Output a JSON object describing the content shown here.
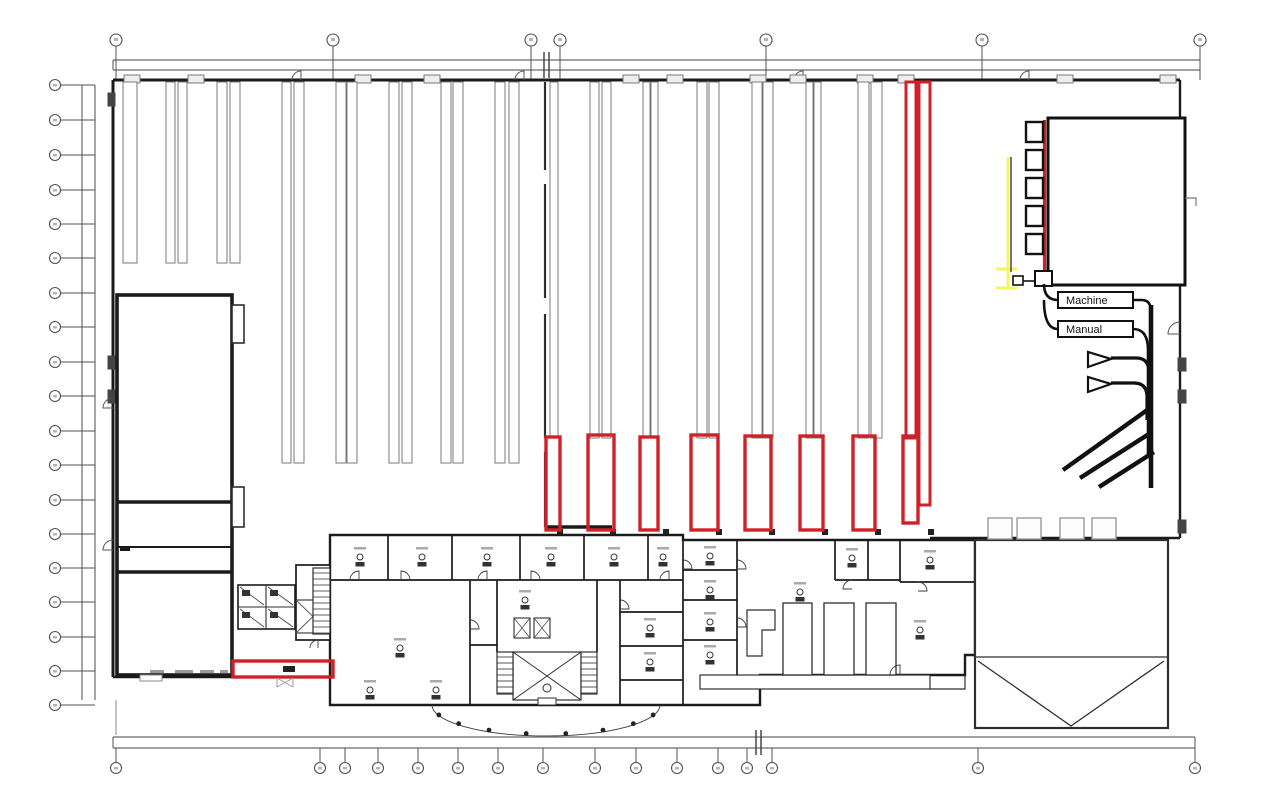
{
  "annotations": {
    "machine_label": "Machine",
    "manual_label": "Manual"
  },
  "colors": {
    "wall": "#1b1b1b",
    "thin": "#2e2e2e",
    "aisle": "#787878",
    "grid": "#505050",
    "light": "#9a9a9a",
    "red": "#d02128",
    "yellow": "#f6f463",
    "faint": "#b5b5b5"
  },
  "grid": {
    "top_bubble_y": 40,
    "top_bubble_xs": [
      116,
      333,
      531,
      560,
      766,
      982,
      1200
    ],
    "left_bubble_x": 55,
    "left_bubble_ys": [
      85,
      120,
      155,
      190,
      224,
      258,
      293,
      327,
      362,
      396,
      431,
      465,
      500,
      534,
      568,
      602,
      637,
      671,
      705
    ],
    "bottom_bubble_y": 768,
    "bottom_bubble_xs": [
      116,
      320,
      345,
      378,
      418,
      458,
      498,
      543,
      595,
      636,
      677,
      718,
      747,
      772,
      978,
      1195
    ]
  },
  "warehouse": {
    "aisle_strips": [
      {
        "x": 123,
        "w": 14,
        "y1": 82,
        "y2": 263
      },
      {
        "x": 166,
        "w": 9,
        "y1": 82,
        "y2": 263
      },
      {
        "x": 178,
        "w": 9,
        "y1": 82,
        "y2": 263
      },
      {
        "x": 217,
        "w": 10,
        "y1": 82,
        "y2": 263
      },
      {
        "x": 230,
        "w": 10,
        "y1": 82,
        "y2": 263
      },
      {
        "x": 282,
        "w": 9,
        "y1": 82,
        "y2": 463
      },
      {
        "x": 294,
        "w": 10,
        "y1": 82,
        "y2": 463
      },
      {
        "x": 336,
        "w": 10,
        "y1": 82,
        "y2": 463
      },
      {
        "x": 347,
        "w": 10,
        "y1": 82,
        "y2": 463
      },
      {
        "x": 389,
        "w": 10,
        "y1": 82,
        "y2": 463
      },
      {
        "x": 402,
        "w": 10,
        "y1": 82,
        "y2": 463
      },
      {
        "x": 441,
        "w": 10,
        "y1": 82,
        "y2": 463
      },
      {
        "x": 453,
        "w": 10,
        "y1": 82,
        "y2": 463
      },
      {
        "x": 495,
        "w": 10,
        "y1": 82,
        "y2": 463
      },
      {
        "x": 509,
        "w": 10,
        "y1": 82,
        "y2": 463
      },
      {
        "x": 550,
        "w": 8,
        "y1": 82,
        "y2": 438
      },
      {
        "x": 590,
        "w": 9,
        "y1": 82,
        "y2": 438
      },
      {
        "x": 602,
        "w": 9,
        "y1": 82,
        "y2": 438
      },
      {
        "x": 643,
        "w": 7,
        "y1": 82,
        "y2": 438
      },
      {
        "x": 651,
        "w": 7,
        "y1": 82,
        "y2": 438
      },
      {
        "x": 697,
        "w": 10,
        "y1": 82,
        "y2": 438
      },
      {
        "x": 709,
        "w": 10,
        "y1": 82,
        "y2": 438
      },
      {
        "x": 752,
        "w": 10,
        "y1": 82,
        "y2": 438
      },
      {
        "x": 763,
        "w": 10,
        "y1": 82,
        "y2": 438
      },
      {
        "x": 806,
        "w": 7,
        "y1": 82,
        "y2": 438
      },
      {
        "x": 814,
        "w": 7,
        "y1": 82,
        "y2": 438
      },
      {
        "x": 858,
        "w": 11,
        "y1": 82,
        "y2": 438
      },
      {
        "x": 871,
        "w": 11,
        "y1": 82,
        "y2": 438
      }
    ],
    "wall_columns_xs": [
      560,
      613,
      666,
      719,
      772,
      825,
      878,
      931
    ],
    "top_door_rect_xs": [
      124,
      188,
      355,
      424,
      623,
      667,
      750,
      790,
      857,
      898,
      1057,
      1160
    ],
    "top_arc_xs": [
      292,
      515,
      794,
      1020
    ]
  },
  "red_overlay": {
    "boxes": [
      [
        546,
        437,
        14,
        93
      ],
      [
        588,
        435,
        26,
        95
      ],
      [
        640,
        437,
        18,
        93
      ],
      [
        691,
        435,
        27,
        95
      ],
      [
        745,
        436,
        26,
        94
      ],
      [
        800,
        436,
        23,
        94
      ],
      [
        853,
        436,
        22,
        94
      ],
      [
        903,
        436,
        15,
        87
      ]
    ],
    "columns": [
      [
        906,
        82,
        10,
        356
      ],
      [
        919,
        82,
        11,
        423
      ]
    ],
    "bottom_box": [
      233,
      661,
      100,
      16
    ],
    "rack_line": [
      1044.5,
      120,
      1044.5,
      287
    ]
  },
  "right_zone": {
    "square_x": 1026,
    "square_w": 17,
    "square_h": 20,
    "square_ys": [
      122,
      150,
      178,
      206,
      234
    ],
    "big_room": [
      1048,
      118,
      137,
      167
    ],
    "machine_box": [
      1058,
      292,
      75,
      16
    ],
    "manual_box": [
      1058,
      321,
      75,
      16
    ],
    "funnel_ys": [
      352,
      377
    ],
    "diagonals": [
      [
        1063,
        470,
        1150,
        408
      ],
      [
        1080,
        478,
        1152,
        432
      ],
      [
        1099,
        487,
        1154,
        452
      ]
    ]
  },
  "yard": {
    "rect": [
      975,
      540,
      193,
      188
    ],
    "split_y": 657,
    "v_apex": [
      1071,
      726
    ],
    "dock_xs": [
      988,
      1017,
      1060,
      1092
    ],
    "dock_y": 518,
    "dock_w": 24,
    "dock_h": 21
  },
  "office": {
    "stairs": [
      [
        497,
        652,
        16,
        42
      ],
      [
        581,
        652,
        16,
        42
      ],
      [
        313,
        568,
        17,
        66
      ]
    ],
    "elevators": [
      [
        514,
        618,
        16,
        20
      ],
      [
        534,
        618,
        16,
        20
      ]
    ],
    "tables": [
      [
        783,
        603,
        29,
        72
      ],
      [
        824,
        603,
        30,
        72
      ],
      [
        866,
        603,
        30,
        72
      ]
    ],
    "desks": [
      [
        360,
        557
      ],
      [
        422,
        557
      ],
      [
        487,
        557
      ],
      [
        551,
        557
      ],
      [
        614,
        557
      ],
      [
        663,
        557
      ],
      [
        400,
        648
      ],
      [
        650,
        628
      ],
      [
        650,
        662
      ],
      [
        525,
        600
      ],
      [
        710,
        556
      ],
      [
        710,
        590
      ],
      [
        710,
        622
      ],
      [
        710,
        655
      ],
      [
        852,
        558
      ],
      [
        930,
        560
      ],
      [
        800,
        592
      ],
      [
        920,
        630
      ],
      [
        436,
        690
      ],
      [
        370,
        690
      ]
    ]
  }
}
